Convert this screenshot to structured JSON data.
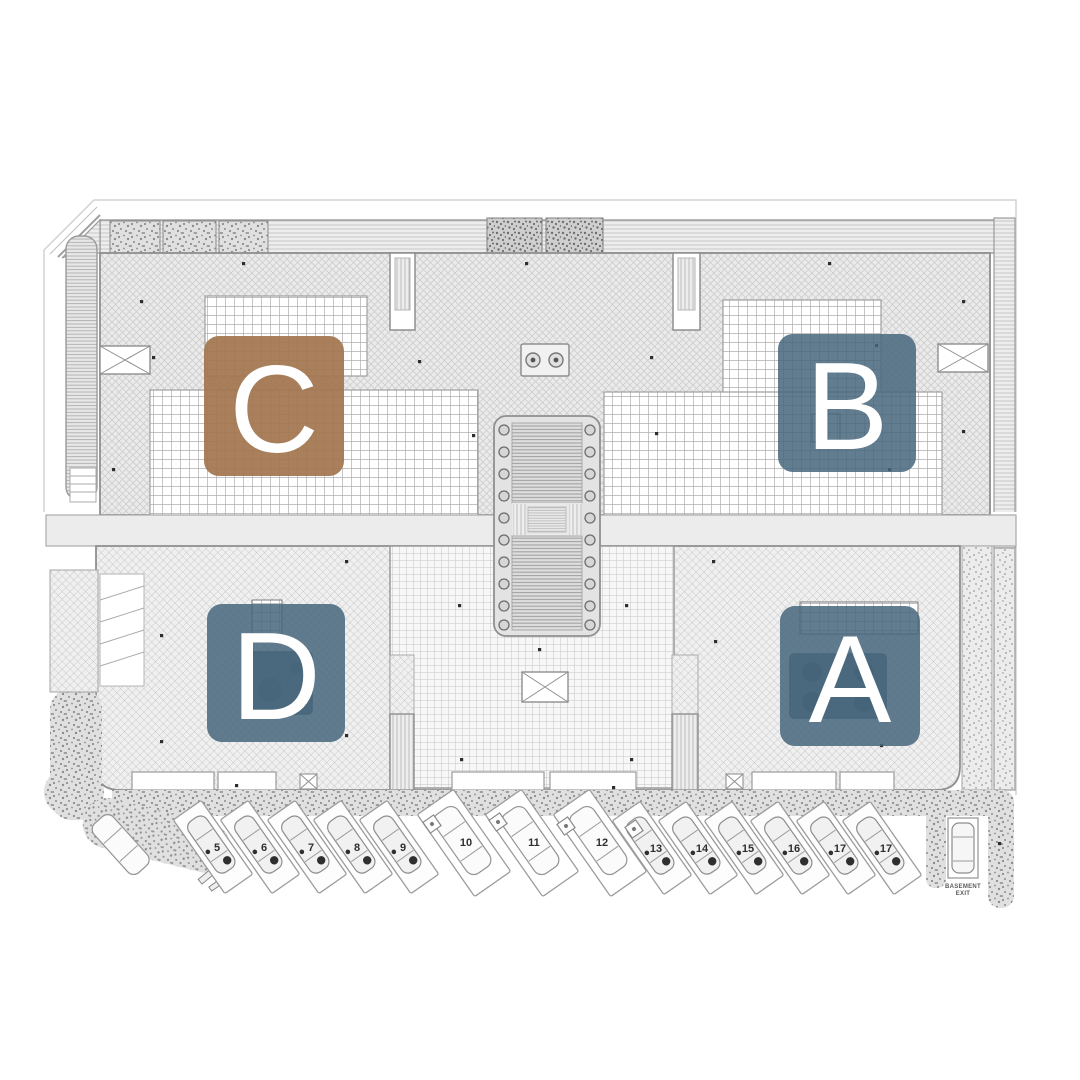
{
  "blocks": [
    {
      "id": "C",
      "label": "C",
      "color": "#a3764f"
    },
    {
      "id": "B",
      "label": "B",
      "color": "#47667c"
    },
    {
      "id": "D",
      "label": "D",
      "color": "#47667c"
    },
    {
      "id": "A",
      "label": "A",
      "color": "#47667c"
    }
  ],
  "parking": {
    "stall_numbers": [
      "5",
      "6",
      "7",
      "8",
      "9",
      "10",
      "11",
      "12",
      "13",
      "14",
      "15",
      "16",
      "17",
      "17"
    ],
    "basement_stall": {
      "line1": "BASEMENT",
      "line2": "EXIT"
    }
  },
  "palette": {
    "letter_color": "#ffffff",
    "brown_block": "#a3764f",
    "blue_block": "#47667c",
    "linework": "#8f8f8f"
  }
}
